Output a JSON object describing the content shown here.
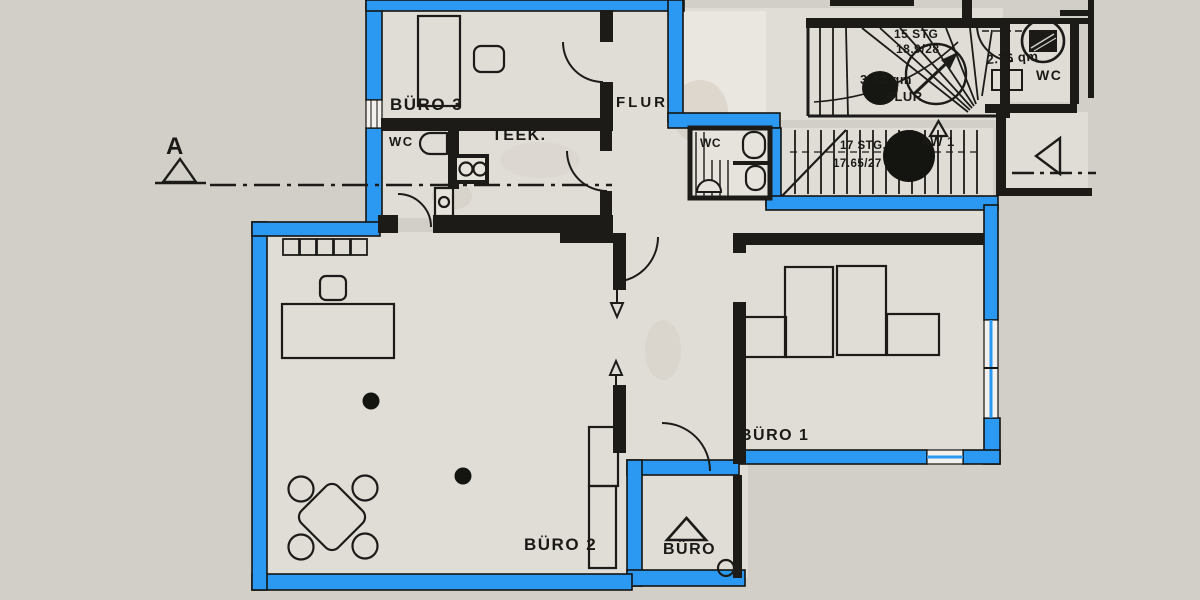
{
  "title": "Grundriss Büroetage (scanned floor plan, exterior walls highlighted blue)",
  "colors": {
    "paper": "#d2cfc9",
    "room_fill": "#e0ddd7",
    "landing_fill": "#eae7e1",
    "line_black": "#1c1b18",
    "accent_blue": "#2b99f2",
    "window_white": "#f2f1ee"
  },
  "labels": {
    "section_marker": "A",
    "buero3": "BÜRO 3",
    "flur": "FLUR",
    "wc_left": "WC",
    "teekueche": "TEEK.",
    "wc_mid": "WC",
    "stairs_upper_line1": "15 STG",
    "stairs_upper_line2": "18.9/28",
    "landing_area": "3.42 qm",
    "landing_name": "FLUR",
    "stairs_lower_line1": "17 STG.",
    "stairs_lower_line2": "17.65/27",
    "aw1": "AW 1",
    "wc_right_area": "2.76 qm",
    "wc_right": "WC",
    "buero1": "BÜRO 1",
    "buero2": "BÜRO 2",
    "buero_entry": "BÜRO"
  }
}
